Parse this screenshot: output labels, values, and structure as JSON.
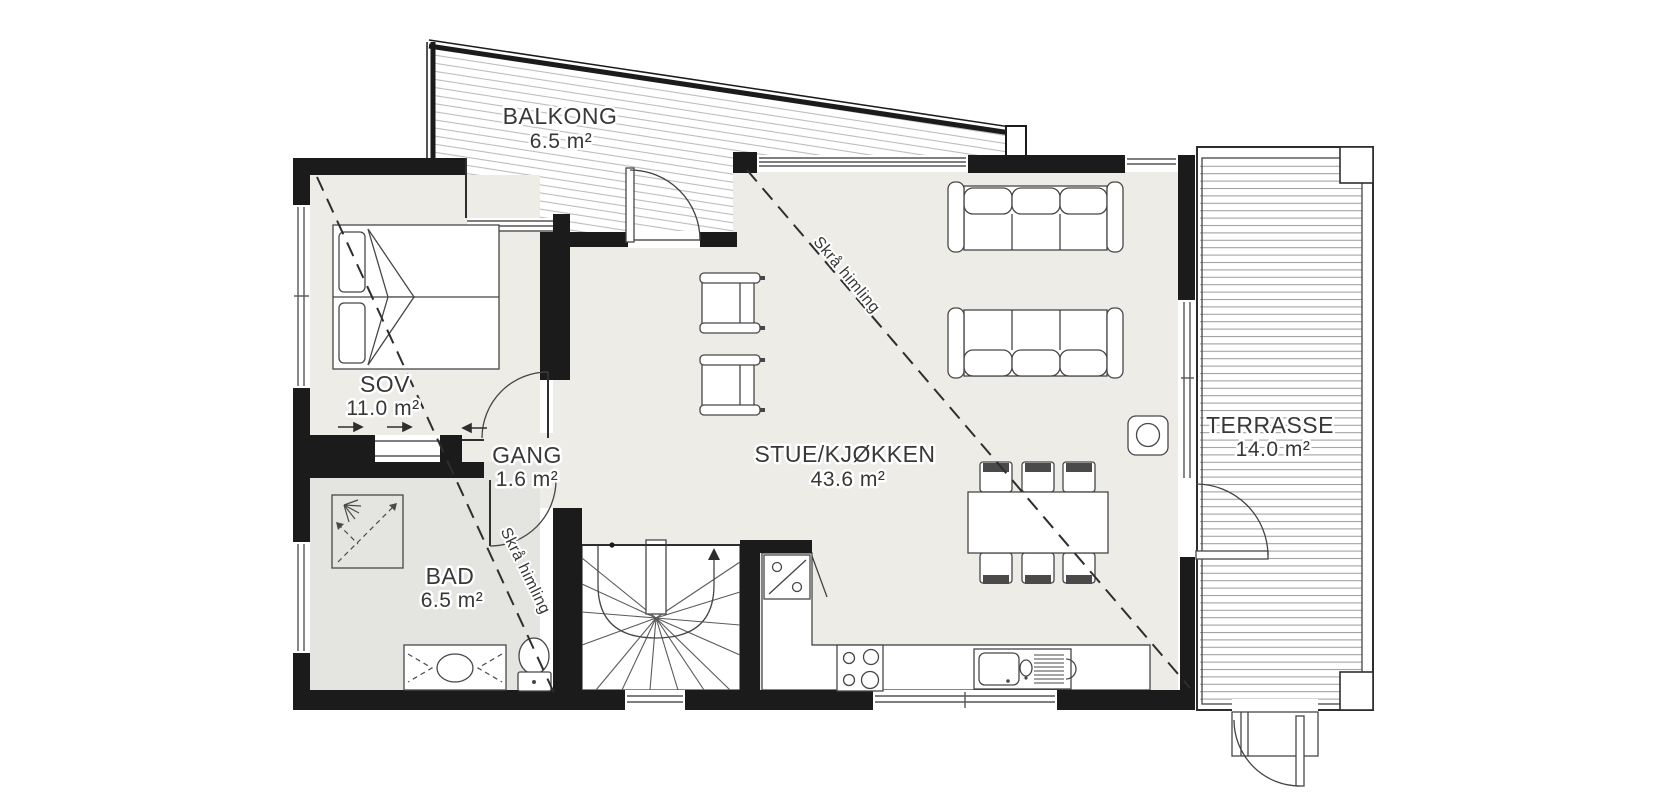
{
  "plan": {
    "type": "floor-plan",
    "colors": {
      "wall": "#1b1b1b",
      "floor": "#edece6",
      "bath_floor": "#e4e4e1",
      "hatch": "#bcbcbc",
      "deck_line": "#9e9e9e",
      "label_text": "#383838"
    },
    "rooms": [
      {
        "id": "balkong",
        "label": "BALKONG",
        "area": "6.5 m²"
      },
      {
        "id": "sov",
        "label": "SOV",
        "area": "11.0 m²"
      },
      {
        "id": "gang",
        "label": "GANG",
        "area": "1.6 m²"
      },
      {
        "id": "bad",
        "label": "BAD",
        "area": "6.5 m²"
      },
      {
        "id": "stue_kjokken",
        "label": "STUE/KJØKKEN",
        "area": "43.6 m²"
      },
      {
        "id": "terrasse",
        "label": "TERRASSE",
        "area": "14.0 m²"
      }
    ],
    "annotations": {
      "sloped_ceiling_main": "Skrå himling",
      "sloped_ceiling_bad": "Skrå himling"
    }
  }
}
